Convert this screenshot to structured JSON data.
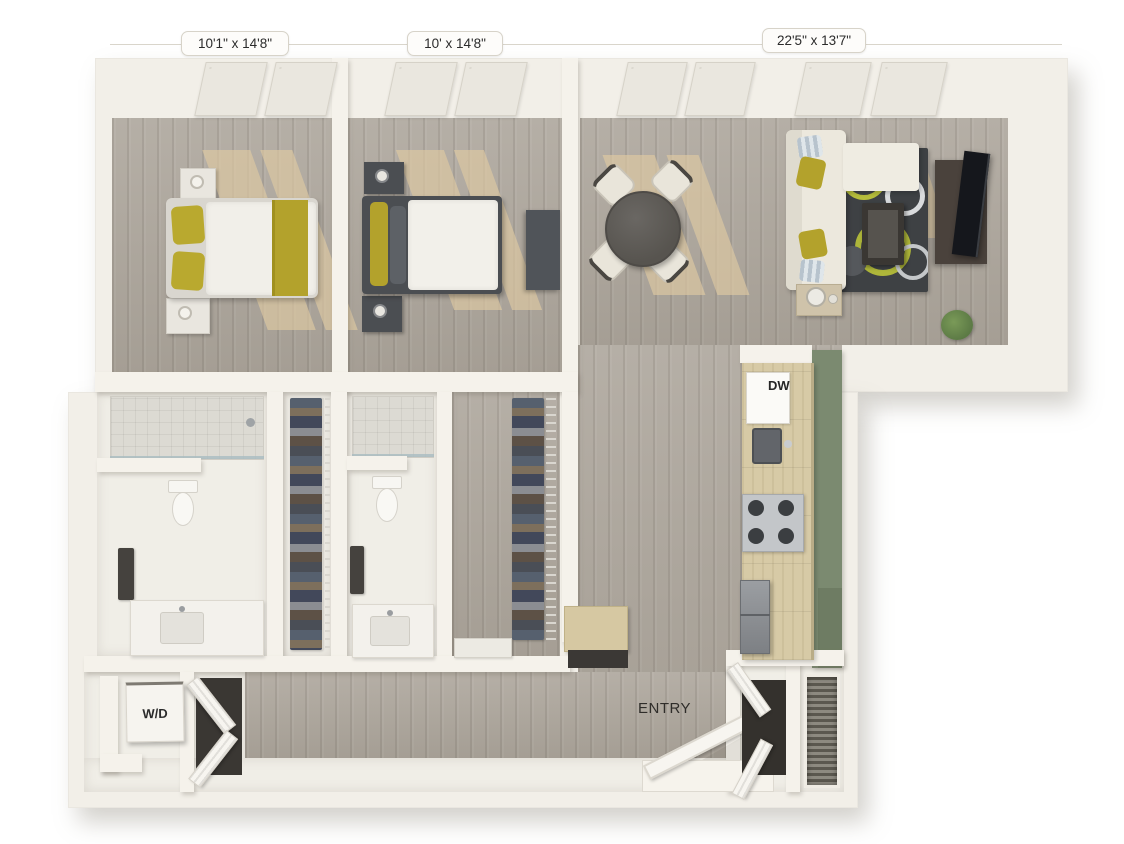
{
  "floor_plan": {
    "room_dimensions": [
      {
        "id": "bedroom-1",
        "text": "10'1\" x 14'8\""
      },
      {
        "id": "bedroom-2",
        "text": "10' x 14'8\""
      },
      {
        "id": "living-room",
        "text": "22'5\" x 13'7\""
      }
    ],
    "appliance_labels": {
      "dishwasher": "DW",
      "washer_dryer": "W/D"
    },
    "area_labels": {
      "entry": "ENTRY"
    },
    "colors": {
      "background": "#ffffff",
      "wall": "#f4f1ea",
      "floor_wood": "#ada69c",
      "sunlight_patch": "#ddc9a2",
      "kitchen_counter_wood": "#d7caa6",
      "accent_wall_green": "#7b8a70",
      "bedding_accent_yellow": "#b3a22c",
      "dark_furniture": "#4b4e52",
      "rug_dark": "#3e4144",
      "rug_accent_green": "#b6bd3c",
      "label_text": "#2b2b2b",
      "label_background": "#fdfcfa"
    }
  }
}
